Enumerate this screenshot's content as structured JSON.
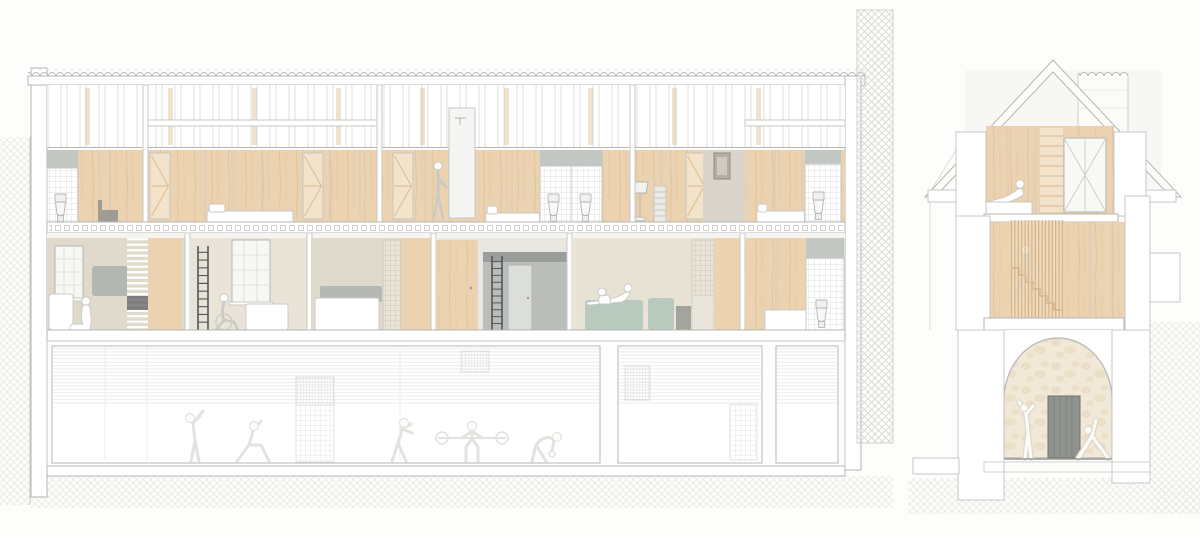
{
  "meta": {
    "title": "Architectural section drawings",
    "description": "Two architectural cross-section drawings: a long longitudinal section showing an attic bedroom level and a living level above a basement gym, and a transverse end section with a gable roof, chimney, timber slat stair screen and a stone arched entrance with yoga figures."
  },
  "palette": {
    "paper": "#fdfdfc",
    "ink": "#9b9b97",
    "ink-soft": "#b5b5b1",
    "ink-faint": "#c7c7c3",
    "line-faint": "#e7e7e4",
    "wood": "#ebd2b0",
    "wood-light": "#f3e3cb",
    "wood-streak": "#d9b98e",
    "slat": "#cda87c",
    "stair": "#c69057",
    "beige": "#dfdacc",
    "beige-light": "#e9e4d7",
    "tile-line": "#d2d6d8",
    "gray-wall": "#c3c7c3",
    "gray-mid": "#aeb2ae",
    "gray-dark": "#53575a",
    "gray-door": "#90938e",
    "sofa-green": "#b8c9be",
    "stone-bg": "#f1e8d7",
    "stone-blob": "#e5d6b9",
    "hatch": "#e4e4e0",
    "hatch-dark": "#d7d7d3",
    "fig": "#c9c9c5",
    "fig-faint": "#e2e2de"
  },
  "views": [
    {
      "id": "longitudinal-section",
      "levels": [
        "attic-bedrooms",
        "living-level",
        "basement-gym"
      ],
      "fixtures": {
        "toilets": 4,
        "beds": 3,
        "wardrobe-doors": 5,
        "windows": 2,
        "ladders": 2,
        "interior-doors": 2,
        "sofas": 4,
        "floor-lamps": 1,
        "picture-frames": 1,
        "showers": 1,
        "slat-screens": 2
      },
      "figures": [
        "seated-person",
        "wheelchair-user",
        "standing-person",
        "lounging-couple",
        "stretching",
        "lunging",
        "boxing",
        "barbell-lift",
        "kettlebell-bend"
      ]
    },
    {
      "id": "end-section",
      "levels": [
        "attic-loft",
        "stair-level",
        "arched-entry"
      ],
      "features": [
        "gable-roof",
        "chimney",
        "x-braced-window",
        "timber-slat-screen",
        "staircase",
        "stone-arch",
        "entry-door"
      ],
      "figures": [
        "lounging-person",
        "person-on-stair",
        "yoga-standing",
        "yoga-triangle"
      ]
    }
  ]
}
